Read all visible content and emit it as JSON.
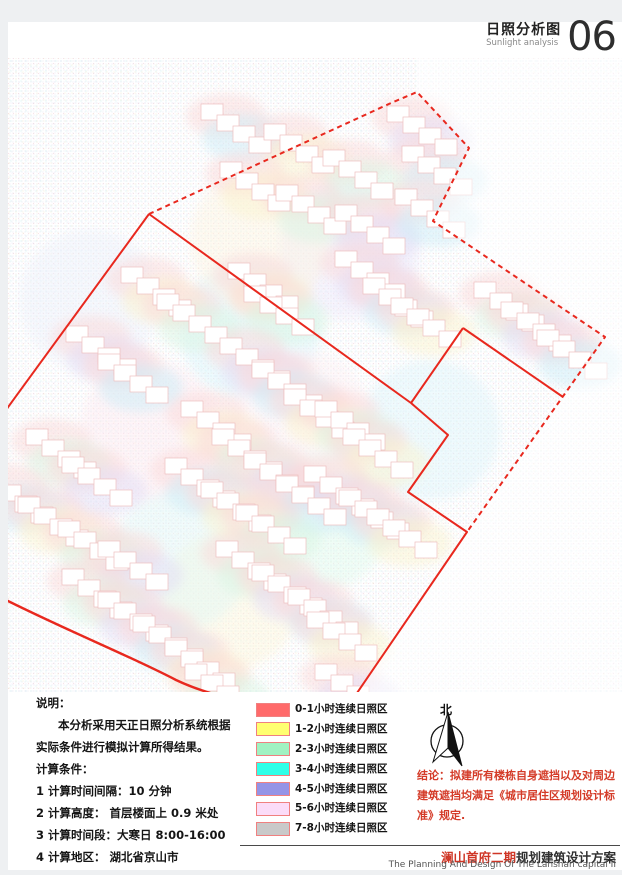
{
  "header": {
    "title_cn": "日照分析图",
    "title_en": "Sunlight analysis",
    "page_no": "06"
  },
  "notes": {
    "heading": "说明：",
    "lines": [
      "本分析采用天正日照分析系统根据",
      "实际条件进行模拟计算所得结果。",
      "计算条件：",
      "1 计算时间间隔：10 分钟",
      "2 计算高度： 首层楼面上 0.9 米处",
      "3 计算时间段：大寒日 8:00-16:00",
      "4 计算地区： 湖北省京山市"
    ]
  },
  "legend": {
    "swatch_border": "#f08080",
    "items": [
      {
        "label": "0-1小时连续日照区",
        "color": "#ff6a6a"
      },
      {
        "label": "1-2小时连续日照区",
        "color": "#ffff70"
      },
      {
        "label": "2-3小时连续日照区",
        "color": "#a0f2c2"
      },
      {
        "label": "3-4小时连续日照区",
        "color": "#2fffe8"
      },
      {
        "label": "4-5小时连续日照区",
        "color": "#9494e6"
      },
      {
        "label": "5-6小时连续日照区",
        "color": "#fbdcf8"
      },
      {
        "label": "7-8小时连续日照区",
        "color": "#c9c9c9"
      }
    ]
  },
  "compass": {
    "label": "北"
  },
  "conclusion": {
    "text": "结论：拟建所有楼栋自身遮挡以及对周边建筑遮挡均满足《城市居住区规划设计标准》规定.",
    "color": "#d43b28"
  },
  "footer": {
    "project_cn_highlight": "澜山首府二期",
    "project_cn_rest": "规划建筑设计方案",
    "project_en": "The Planning And Design Of The Lanshan capital II"
  },
  "map": {
    "boundary_color": "#e8281e",
    "building_stroke": "#eec0c0",
    "dashed_boundary": [
      [
        149,
        214
      ],
      [
        391,
        103
      ],
      [
        417,
        92
      ],
      [
        469,
        148
      ],
      [
        433,
        221
      ],
      [
        605,
        337
      ],
      [
        467,
        532
      ]
    ],
    "solid_boundaries": [
      [
        [
          149,
          214
        ],
        [
          3,
          414
        ]
      ],
      [
        [
          149,
          214
        ],
        [
          411,
          403
        ]
      ],
      [
        [
          463,
          328
        ],
        [
          411,
          403
        ]
      ],
      [
        [
          463,
          328
        ],
        [
          563,
          397
        ]
      ],
      [
        [
          411,
          403
        ],
        [
          448,
          435
        ],
        [
          408,
          492
        ],
        [
          467,
          532
        ],
        [
          357,
          693
        ]
      ]
    ],
    "road": "M 2,598 C 70,632 130,656 176,680 C 214,698 260,706 322,714",
    "outside_mask": [
      [
        417,
        58
      ],
      [
        417,
        92
      ],
      [
        469,
        148
      ],
      [
        433,
        221
      ],
      [
        605,
        337
      ],
      [
        467,
        532
      ],
      [
        357,
        693
      ],
      [
        622,
        693
      ],
      [
        622,
        58
      ]
    ],
    "washes": [
      [
        250,
        330,
        "#d8f4fa"
      ],
      [
        150,
        430,
        "#fde9ef"
      ],
      [
        320,
        520,
        "#defaec"
      ],
      [
        230,
        600,
        "#fcf7d9"
      ],
      [
        350,
        250,
        "#ece6fb"
      ],
      [
        430,
        430,
        "#dcf5fa"
      ],
      [
        90,
        300,
        "#eaf0fa"
      ],
      [
        300,
        420,
        "#fdeff4"
      ],
      [
        180,
        560,
        "#e0f7f7"
      ],
      [
        260,
        240,
        "#fdf3df"
      ]
    ],
    "halo_colors": [
      "#cdeef8",
      "#fbf3cf",
      "#d9f5e3",
      "#e4def6"
    ],
    "buildings": [
      [
        234,
        128
      ],
      [
        297,
        148
      ],
      [
        356,
        174
      ],
      [
        420,
        130
      ],
      [
        435,
        170
      ],
      [
        253,
        186
      ],
      [
        309,
        209
      ],
      [
        368,
        229
      ],
      [
        428,
        213
      ],
      [
        154,
        291
      ],
      [
        190,
        318
      ],
      [
        99,
        350
      ],
      [
        131,
        378
      ],
      [
        261,
        287
      ],
      [
        277,
        310
      ],
      [
        253,
        362
      ],
      [
        285,
        386
      ],
      [
        317,
        413
      ],
      [
        348,
        425
      ],
      [
        368,
        275
      ],
      [
        396,
        302
      ],
      [
        424,
        322
      ],
      [
        507,
        306
      ],
      [
        534,
        326
      ],
      [
        570,
        354
      ],
      [
        214,
        425
      ],
      [
        245,
        453
      ],
      [
        277,
        477
      ],
      [
        309,
        500
      ],
      [
        376,
        453
      ],
      [
        59,
        453
      ],
      [
        95,
        481
      ],
      [
        16,
        498
      ],
      [
        51,
        521
      ],
      [
        91,
        545
      ],
      [
        131,
        565
      ],
      [
        198,
        482
      ],
      [
        234,
        506
      ],
      [
        269,
        529
      ],
      [
        337,
        490
      ],
      [
        372,
        514
      ],
      [
        400,
        533
      ],
      [
        95,
        593
      ],
      [
        131,
        616
      ],
      [
        166,
        640
      ],
      [
        198,
        664
      ],
      [
        249,
        565
      ],
      [
        285,
        589
      ],
      [
        321,
        613
      ],
      [
        340,
        636
      ],
      [
        218,
        688
      ],
      [
        348,
        688
      ]
    ]
  }
}
